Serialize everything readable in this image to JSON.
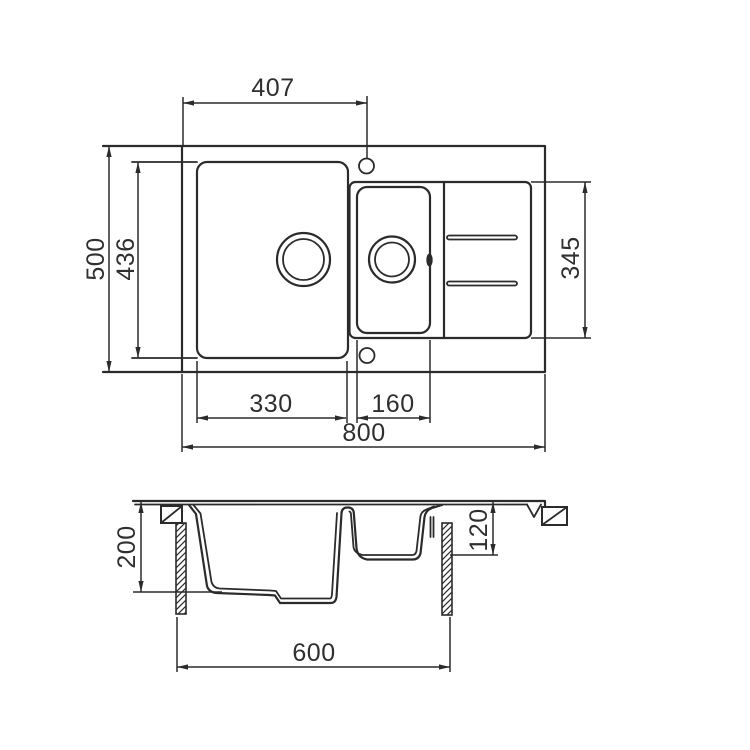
{
  "drawing": {
    "line_color": "#2b2b2b",
    "background": "#ffffff",
    "top_view": {
      "dims": {
        "faucet_hole_offset": "407",
        "overall_depth": "500",
        "main_bowl_depth": "436",
        "drainer_length": "345",
        "main_bowl_width": "330",
        "half_bowl_width": "160",
        "overall_width": "800"
      }
    },
    "section_view": {
      "dims": {
        "main_bowl_height": "200",
        "half_bowl_height": "120",
        "base_cabinet_width": "600"
      }
    }
  }
}
